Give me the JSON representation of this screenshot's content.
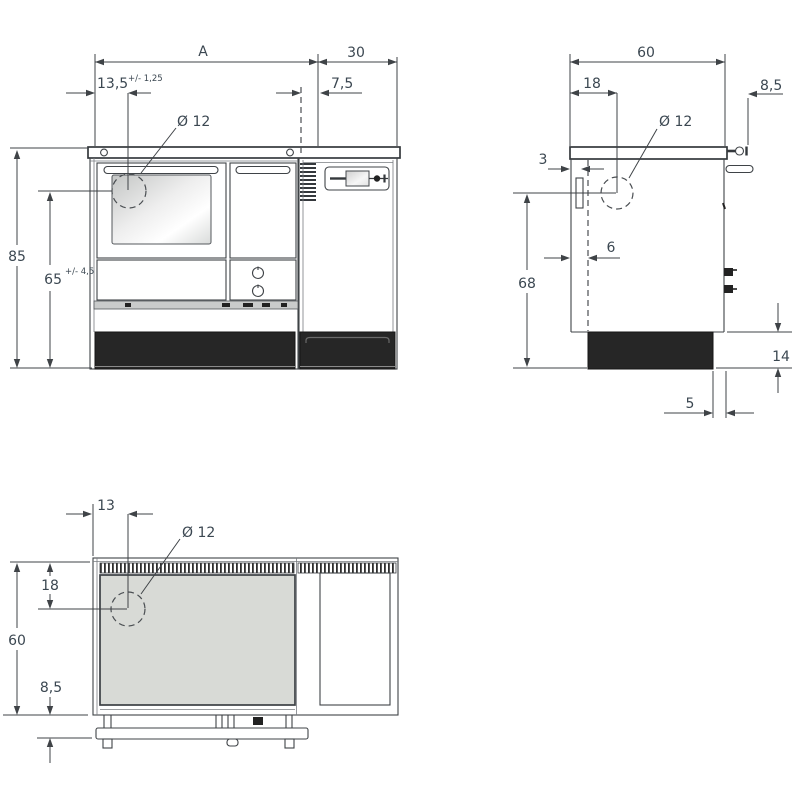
{
  "front_view": {
    "label_a": "A",
    "label_30": "30",
    "label_13_5": "13,5",
    "tol_13_5": "+/- 1,25",
    "label_7_5": "7,5",
    "label_dia": "Ø 12",
    "label_85": "85",
    "label_65": "65",
    "tol_65": "+/- 4,5"
  },
  "side_view": {
    "label_60": "60",
    "label_18": "18",
    "label_8_5": "8,5",
    "label_dia": "Ø 12",
    "label_3": "3",
    "label_6": "6",
    "label_68": "68",
    "label_14": "14",
    "label_5": "5"
  },
  "top_view": {
    "label_13": "13",
    "label_dia": "Ø 12",
    "label_18": "18",
    "label_60": "60",
    "label_8_5": "8,5"
  },
  "colors": {
    "line": "#3f4347",
    "text": "#3b4751",
    "plinth": "#262626",
    "cooktop": "#d8dad6"
  }
}
